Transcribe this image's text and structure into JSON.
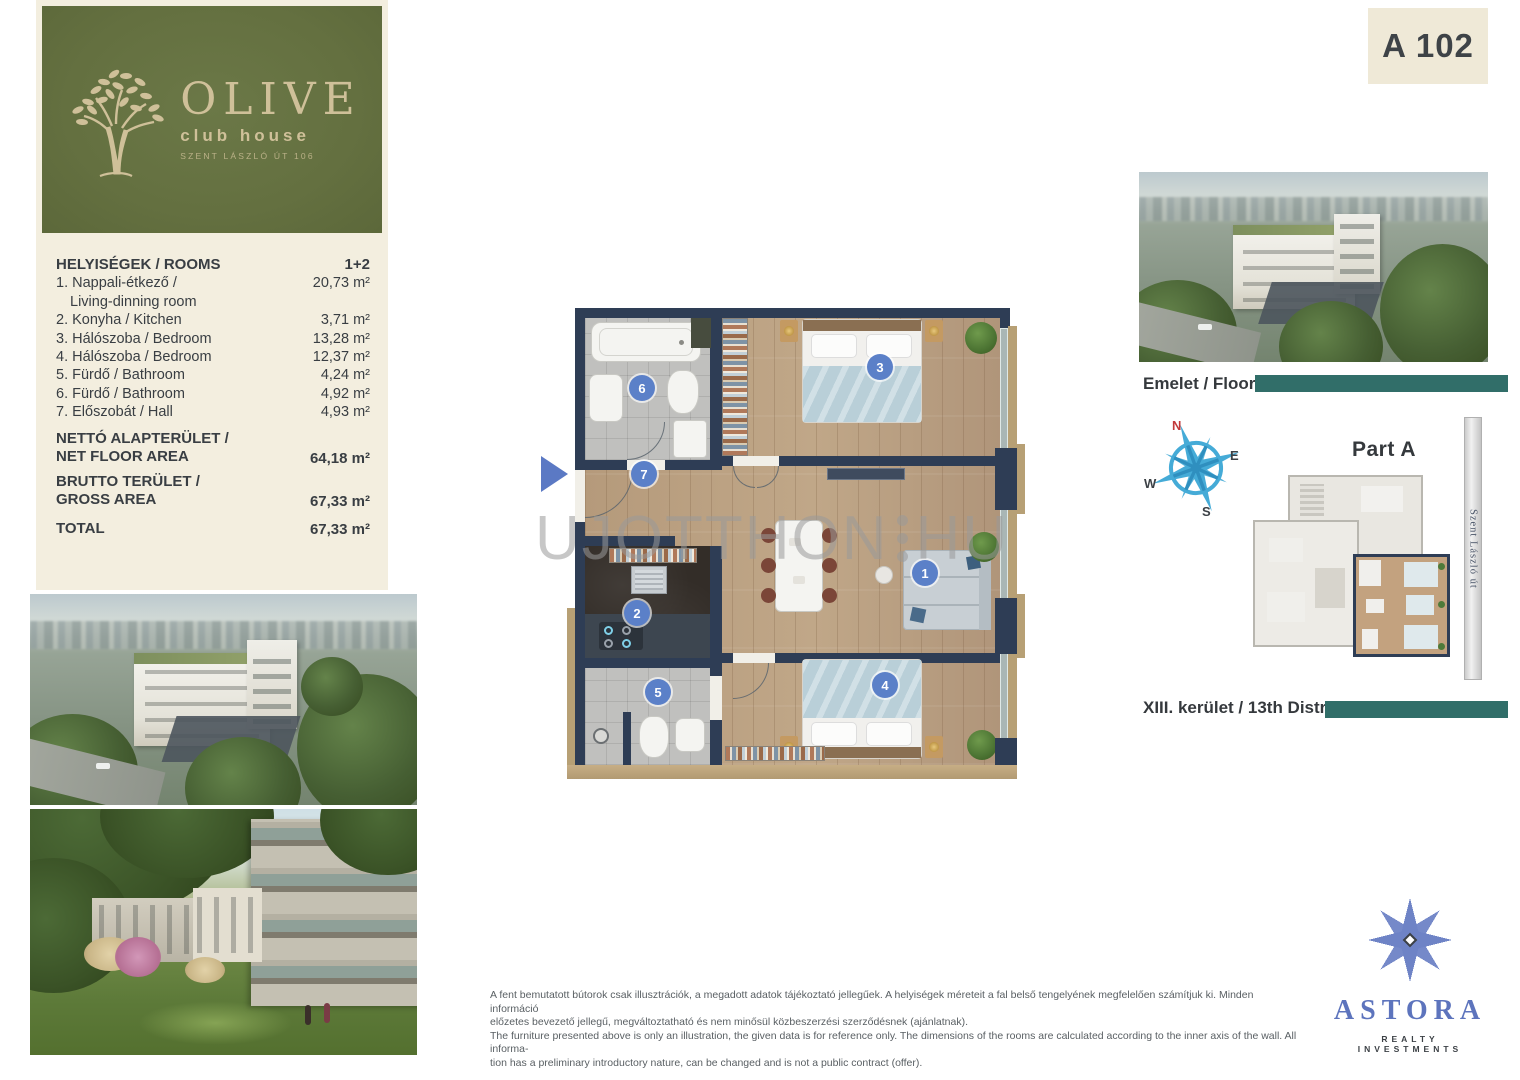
{
  "unit_badge": "A 102",
  "logo": {
    "title": "OLIVE",
    "subtitle": "club house",
    "address": "SZENT LÁSZLÓ ÚT 106"
  },
  "rooms": {
    "header": "HELYISÉGEK / ROOMS",
    "header_value": "1+2",
    "items": [
      {
        "label": "1. Nappali-étkező /",
        "label2": "Living-dinning room",
        "value": "20,73 m²"
      },
      {
        "label": "2. Konyha / Kitchen",
        "value": "3,71 m²"
      },
      {
        "label": "3. Hálószoba / Bedroom",
        "value": "13,28 m²"
      },
      {
        "label": "4. Hálószoba / Bedroom",
        "value": "12,37 m²"
      },
      {
        "label": "5. Fürdő / Bathroom",
        "value": "4,24 m²"
      },
      {
        "label": "6. Fürdő / Bathroom",
        "value": "4,92 m²"
      },
      {
        "label": "7. Előszobát / Hall",
        "value": "4,93 m²"
      }
    ],
    "net": {
      "label": "NETTÓ ALAPTERÜLET /",
      "label2": "NET FLOOR AREA",
      "value": "64,18 m²"
    },
    "gross": {
      "label": "BRUTTO TERÜLET /",
      "label2": "GROSS AREA",
      "value": "67,33 m²"
    },
    "total": {
      "label": "TOTAL",
      "value": "67,33 m²"
    }
  },
  "floorplan": {
    "numbers": [
      "1",
      "2",
      "3",
      "4",
      "5",
      "6",
      "7"
    ],
    "watermark_part1": "UJOTTHON",
    "watermark_part2": "HU"
  },
  "right": {
    "floor_label": "Emelet / Floor 1",
    "part_label": "Part A",
    "street_label": "Szent László út",
    "district_label": "XIII. kerület / 13th District",
    "compass": {
      "n": "N",
      "e": "E",
      "w": "W",
      "s": "S"
    }
  },
  "footer": {
    "disclaimer_hu_1": "A fent bemutatott bútorok csak illusztrációk, a megadott adatok tájékoztató jellegűek. A helyiségek méreteit a fal belső tengelyének megfelelően számítjuk ki. Minden információ",
    "disclaimer_hu_2": "előzetes bevezető jellegű, megváltoztatható és nem minősül közbeszerzési szerződésnek (ajánlatnak).",
    "disclaimer_en_1": "The furniture presented above is only an illustration, the given data is for reference only. The dimensions of the rooms are calculated according to the inner axis of the wall. All informa-",
    "disclaimer_en_2": "tion has a preliminary introductory nature, can be changed and is not a public contract (offer)."
  },
  "brand": {
    "name": "ASTORA",
    "tagline": "REALTY INVESTMENTS"
  },
  "colors": {
    "accent_green": "#647040",
    "gold": "#cfc099",
    "teal": "#316e69",
    "wall_navy": "#2e3d55",
    "circle_blue": "#5b80c8",
    "beige": "#f3eedf"
  }
}
